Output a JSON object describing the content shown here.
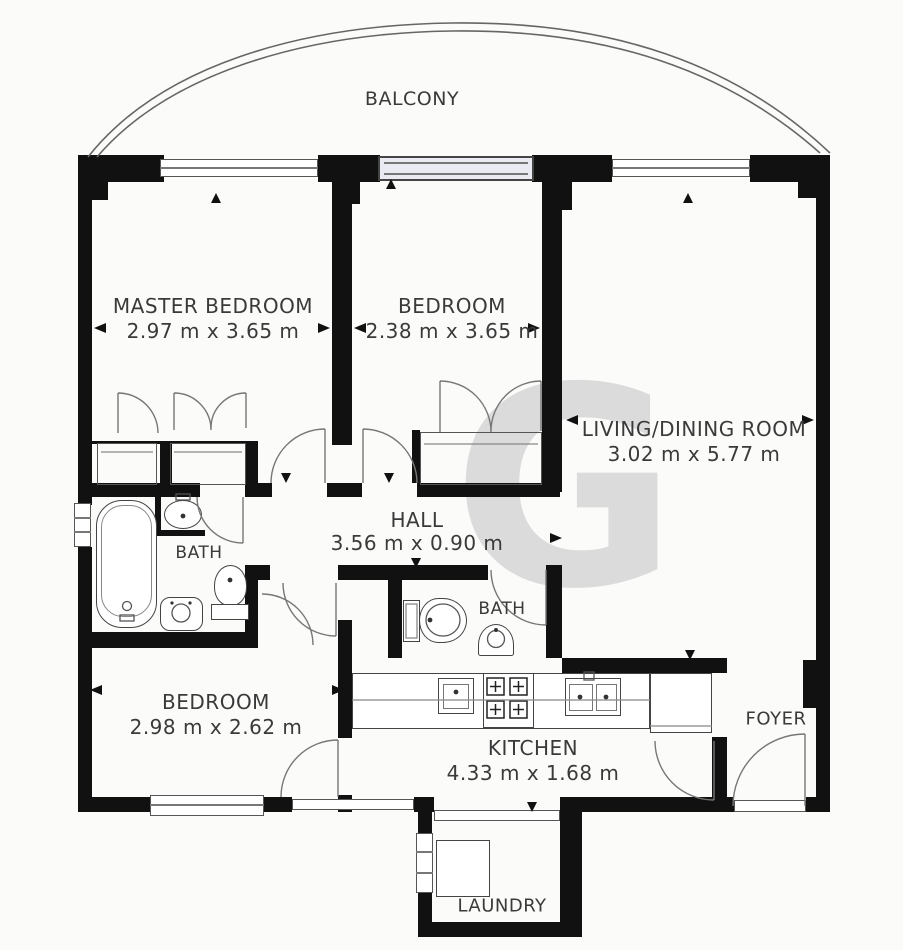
{
  "floorplan": {
    "watermark": "G",
    "balcony": {
      "label": "BALCONY"
    },
    "master_bedroom": {
      "label": "MASTER BEDROOM",
      "dimensions": "2.97 m x 3.65 m"
    },
    "bedroom2": {
      "label": "BEDROOM",
      "dimensions": "2.38 m x 3.65 m"
    },
    "living_dining": {
      "label": "LIVING/DINING ROOM",
      "dimensions": "3.02 m x 5.77 m"
    },
    "hall": {
      "label": "HALL",
      "dimensions": "3.56 m x 0.90 m"
    },
    "bath1": {
      "label": "BATH"
    },
    "bath2": {
      "label": "BATH"
    },
    "bedroom3": {
      "label": "BEDROOM",
      "dimensions": "2.98 m x 2.62 m"
    },
    "kitchen": {
      "label": "KITCHEN",
      "dimensions": "4.33 m x 1.68 m"
    },
    "foyer": {
      "label": "FOYER"
    },
    "laundry": {
      "label": "LAUNDRY"
    },
    "colors": {
      "wall": "#111111",
      "line": "#666666",
      "text": "#3a3a3a",
      "watermark": "#dbdbdb",
      "window_glass": "#e9eaf2"
    }
  }
}
